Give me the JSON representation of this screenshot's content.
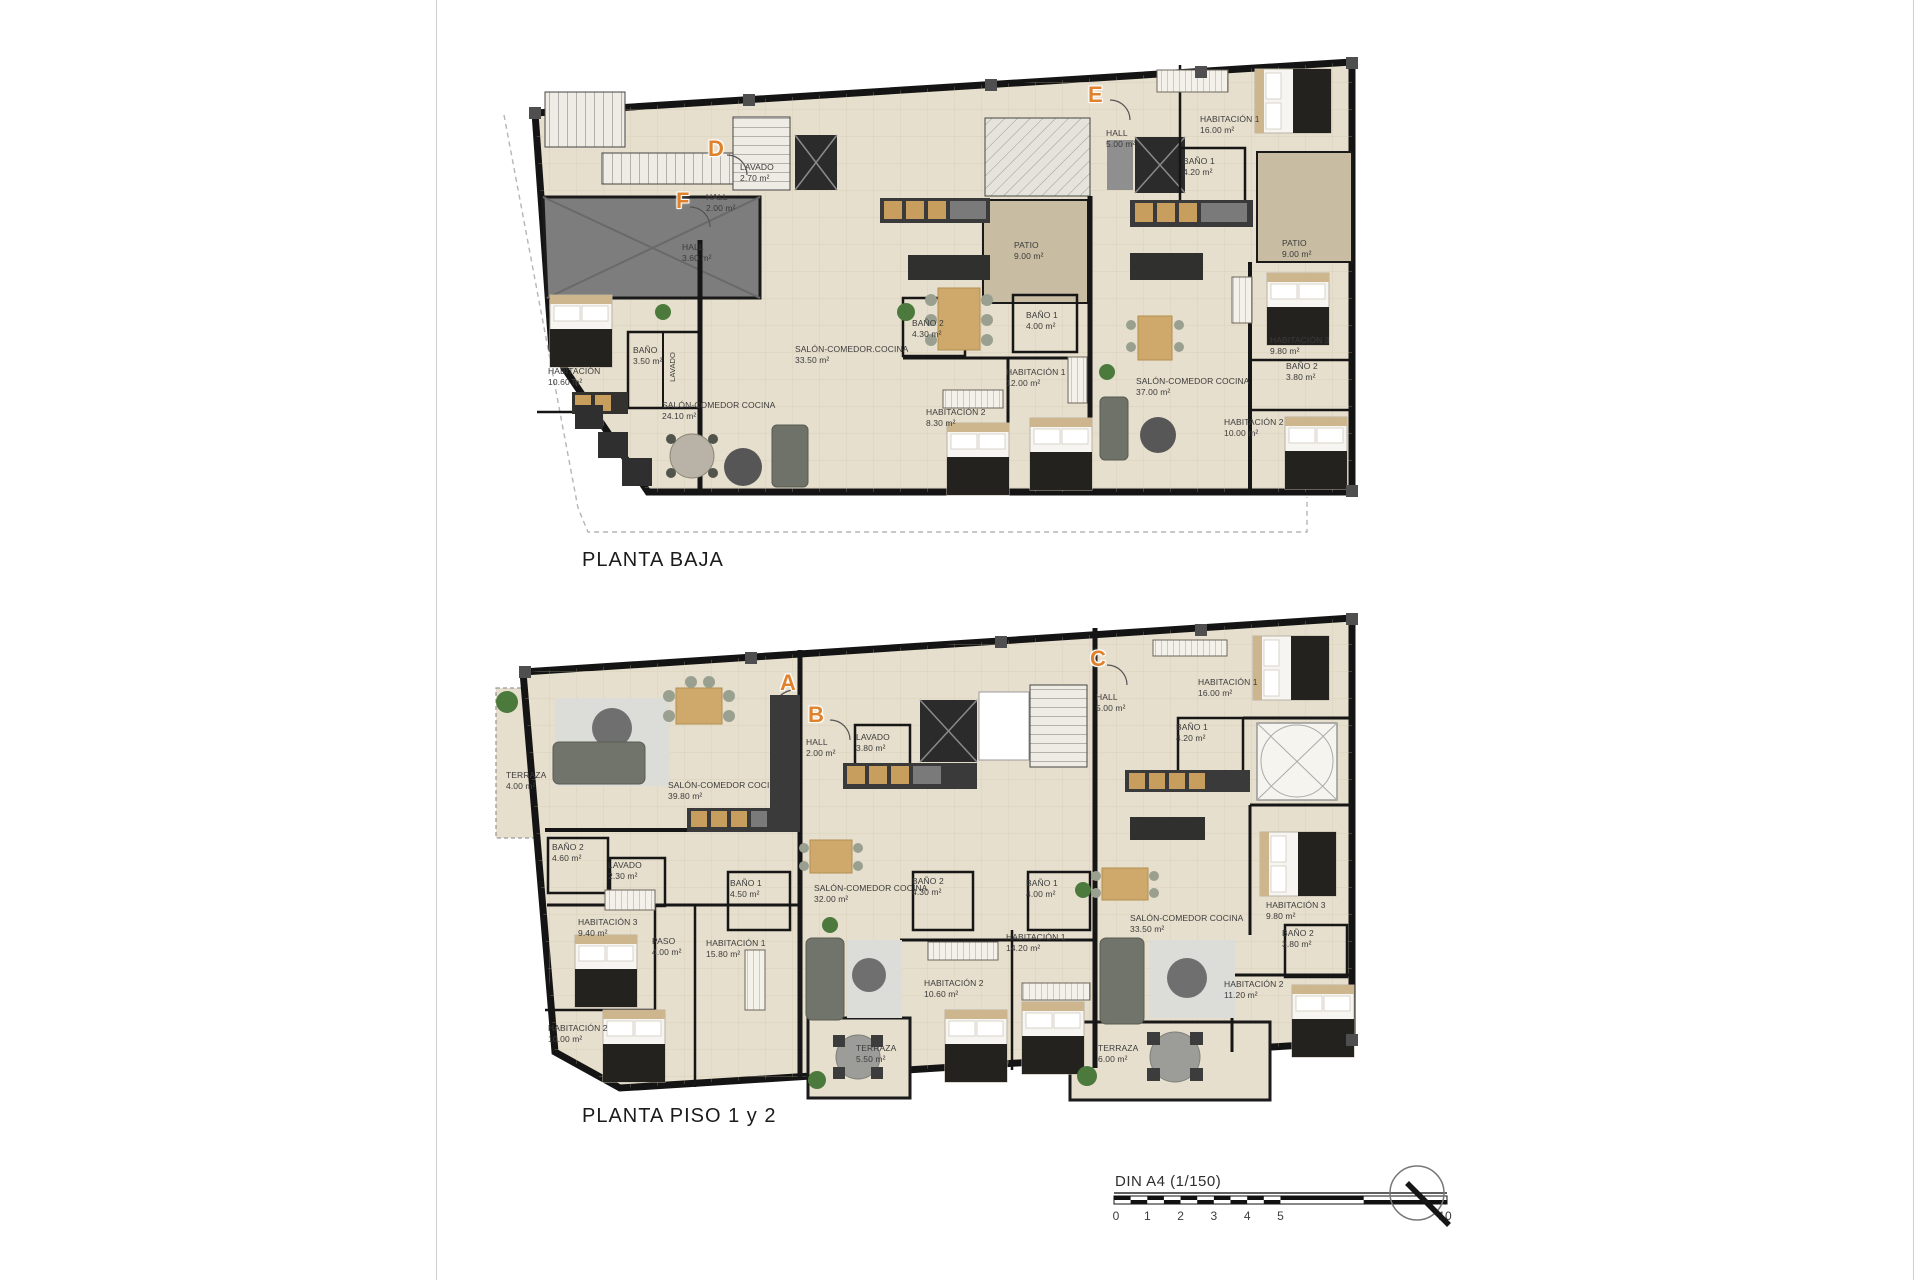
{
  "plans": [
    {
      "title": "PLANTA BAJA",
      "units": [
        {
          "letter": "F",
          "rooms": [
            {
              "name": "HALL",
              "area": "3.60 m²"
            },
            {
              "name": "HABITACIÓN",
              "area": "10.60 m²"
            },
            {
              "name": "BAÑO",
              "area": "3.50 m²"
            },
            {
              "name": "LAVADO",
              "area": ""
            },
            {
              "name": "SALÓN-COMEDOR COCINA",
              "area": "24.10 m²"
            }
          ]
        },
        {
          "letter": "D",
          "rooms": [
            {
              "name": "LAVADO",
              "area": "2.70 m²"
            },
            {
              "name": "HALL",
              "area": "2.00 m²"
            },
            {
              "name": "PATIO",
              "area": "9.00 m²"
            },
            {
              "name": "SALÓN-COMEDOR.COCINA",
              "area": "33.50 m²"
            },
            {
              "name": "BAÑO 2",
              "area": "4.30 m²"
            },
            {
              "name": "BAÑO 1",
              "area": "4.00 m²"
            },
            {
              "name": "HABITACIÓN 1",
              "area": "12.00 m²"
            },
            {
              "name": "HABITACIÓN 2",
              "area": "8.30 m²"
            }
          ]
        },
        {
          "letter": "E",
          "rooms": [
            {
              "name": "HALL",
              "area": "5.00 m²"
            },
            {
              "name": "HABITACIÓN 1",
              "area": "16.00 m²"
            },
            {
              "name": "BAÑO 1",
              "area": "4.20 m²"
            },
            {
              "name": "PATIO",
              "area": "9.00 m²"
            },
            {
              "name": "SALÓN-COMEDOR COCINA",
              "area": "37.00 m²"
            },
            {
              "name": "HABITACIÓN 3",
              "area": "9.80 m²"
            },
            {
              "name": "BAÑO 2",
              "area": "3.80 m²"
            },
            {
              "name": "HABITACIÓN 2",
              "area": "10.00 m²"
            }
          ]
        }
      ]
    },
    {
      "title": "PLANTA PISO 1 y 2",
      "units": [
        {
          "letter": "A",
          "rooms": [
            {
              "name": "TERRAZA",
              "area": "4.00 m²"
            },
            {
              "name": "SALÓN-COMEDOR COCINA",
              "area": "39.80 m²"
            },
            {
              "name": "BAÑO 2",
              "area": "4.60 m²"
            },
            {
              "name": "LAVADO",
              "area": "2.30 m²"
            },
            {
              "name": "BAÑO 1",
              "area": "4.50 m²"
            },
            {
              "name": "HABITACIÓN 3",
              "area": "9.40 m²"
            },
            {
              "name": "PASO",
              "area": "4.00 m²"
            },
            {
              "name": "HABITACIÓN 1",
              "area": "15.80 m²"
            },
            {
              "name": "HABITACIÓN 2",
              "area": "10.00 m²"
            }
          ]
        },
        {
          "letter": "B",
          "rooms": [
            {
              "name": "HALL",
              "area": "2.00 m²"
            },
            {
              "name": "LAVADO",
              "area": "3.80 m²"
            },
            {
              "name": "SALÓN-COMEDOR COCINA",
              "area": "32.00 m²"
            },
            {
              "name": "BAÑO 2",
              "area": "4.30 m²"
            },
            {
              "name": "BAÑO 1",
              "area": "4.00 m²"
            },
            {
              "name": "HABITACIÓN 1",
              "area": "14.20 m²"
            },
            {
              "name": "HABITACIÓN 2",
              "area": "10.60 m²"
            },
            {
              "name": "TERRAZA",
              "area": "5.50 m²"
            }
          ]
        },
        {
          "letter": "C",
          "rooms": [
            {
              "name": "HALL",
              "area": "5.00 m²"
            },
            {
              "name": "HABITACIÓN 1",
              "area": "16.00 m²"
            },
            {
              "name": "BAÑO 1",
              "area": "4.20 m²"
            },
            {
              "name": "SALÓN-COMEDOR COCINA",
              "area": "33.50 m²"
            },
            {
              "name": "HABITACIÓN 3",
              "area": "9.80 m²"
            },
            {
              "name": "BAÑO 2",
              "area": "3.80 m²"
            },
            {
              "name": "HABITACIÓN 2",
              "area": "11.20 m²"
            },
            {
              "name": "TERRAZA",
              "area": "6.00 m²"
            }
          ]
        }
      ]
    }
  ],
  "scale_bar": {
    "label": "DIN A4 (1/150)",
    "ticks": [
      "0",
      "1",
      "2",
      "3",
      "4",
      "5",
      "10"
    ]
  }
}
